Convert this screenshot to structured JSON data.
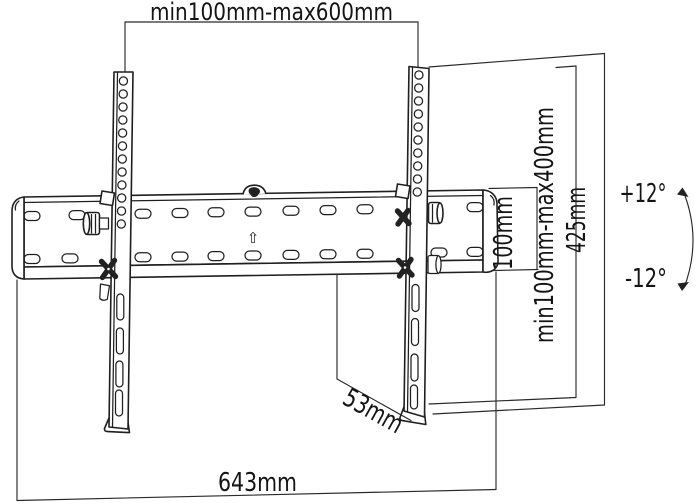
{
  "diagram": {
    "subject": "tilting-tv-wall-mount-technical-drawing",
    "background": "#ffffff",
    "line_color": "#1f1f1f",
    "text_color": "#141414",
    "labels": {
      "vesa_width_range": "min100mm-max600mm",
      "wall_plate_height": "100mm",
      "vesa_height_range": "min100mm-max400mm",
      "bracket_height": "425mm",
      "tilt_up": "+12°",
      "tilt_down": "-12°",
      "profile_depth": "53mm",
      "wall_plate_width": "643mm",
      "orientation_arrow": "⇧"
    }
  }
}
